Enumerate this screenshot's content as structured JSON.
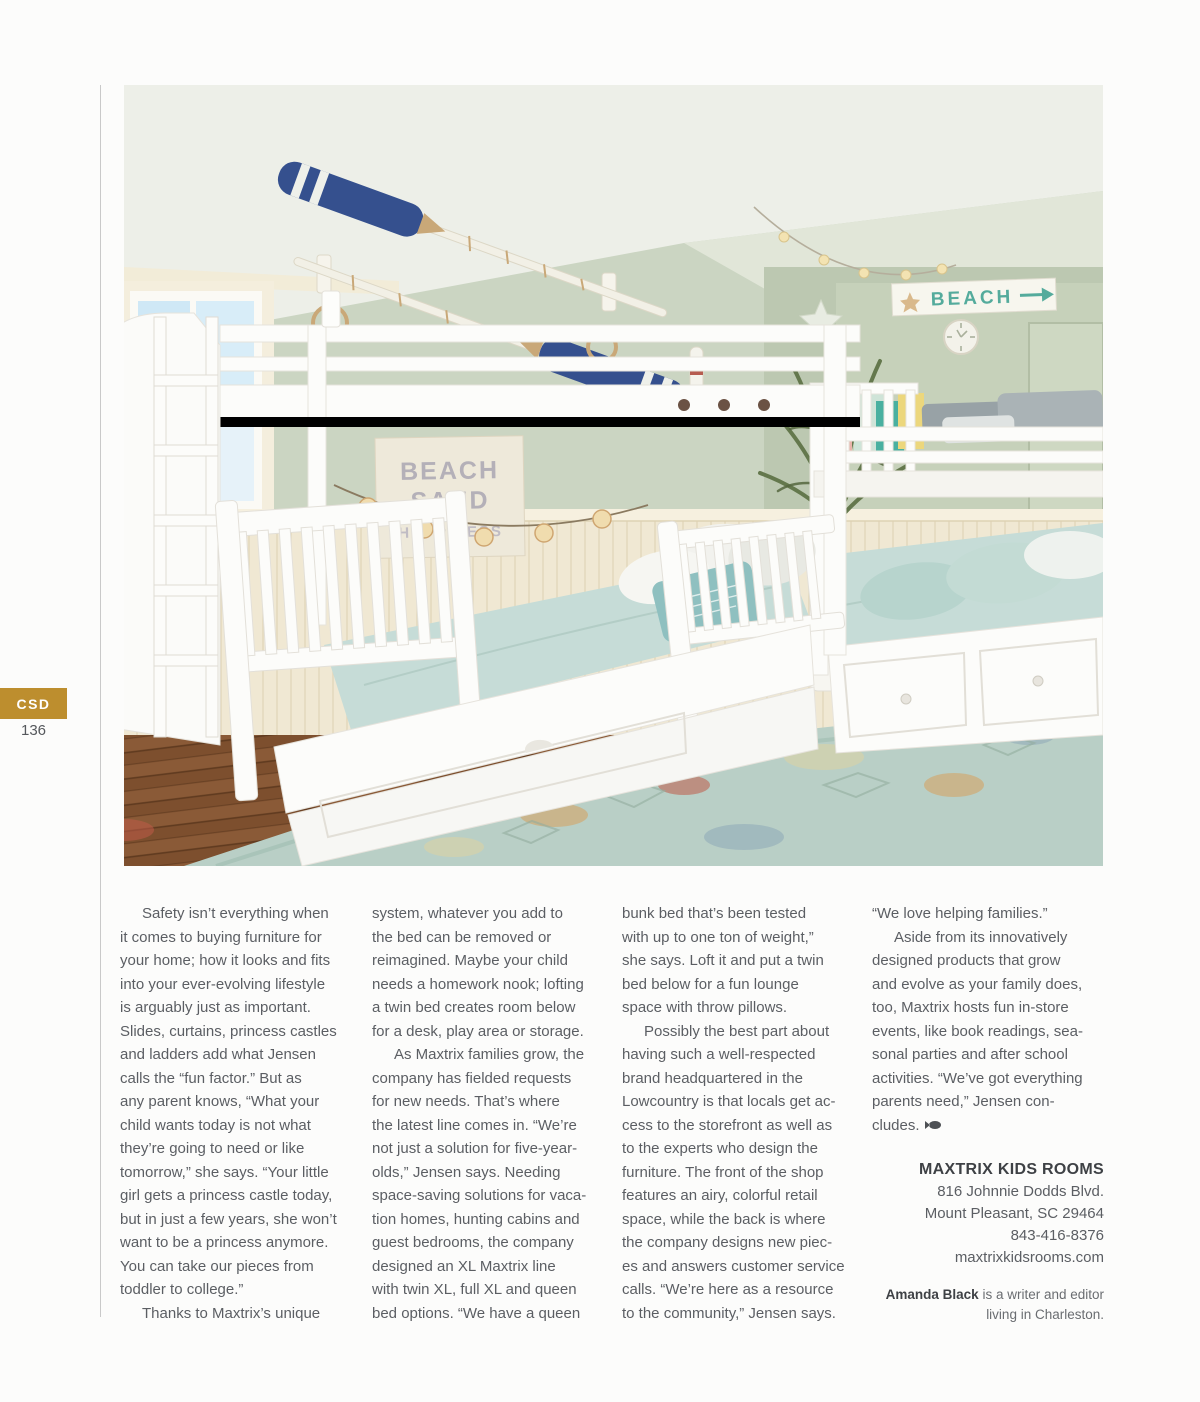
{
  "page": {
    "tab_label": "CSD",
    "page_number": "136",
    "accent_gold": "#bd8e2e"
  },
  "photo": {
    "description": "Coastal kids bedroom with two white bunk beds, seafoam bedding, decorative oars, beach signs, palm plant and distressed aqua rug",
    "beach_sign": "BEACH",
    "wall_art": {
      "line1": "BEACH",
      "line2": "SAND",
      "line3": "HAPPINESS"
    }
  },
  "article": {
    "columns": [
      {
        "paragraphs": [
          {
            "lines": [
              "Safety isn’t everything when",
              "it comes to buying furniture for",
              "your home; how it looks and fits",
              "into your ever-evolving lifestyle",
              "is arguably just as important.",
              "Slides, curtains, princess castles",
              "and ladders add what Jensen",
              "calls the “fun factor.” But as",
              "any parent knows, “What your",
              "child wants today is not what",
              "they’re going to need or like",
              "tomorrow,” she says. “Your little",
              "girl gets a princess castle today,",
              "but in just a few years, she won’t",
              "want to be a princess anymore.",
              "You can take our pieces from",
              "toddler to college.”"
            ]
          },
          {
            "lines": [
              "Thanks to Maxtrix’s unique"
            ]
          }
        ]
      },
      {
        "paragraphs": [
          {
            "lines": [
              "system, whatever you add to",
              "the bed can be removed or",
              "reimagined. Maybe your child",
              "needs a homework nook; lofting",
              "a twin bed creates room below",
              "for a desk, play area or storage."
            ]
          },
          {
            "lines": [
              "As Maxtrix families grow, the",
              "company has fielded requests",
              "for new needs. That’s where",
              "the latest line comes in. “We’re",
              "not just a solution for five-year-",
              "olds,” Jensen says. Needing",
              "space-saving solutions for vaca-",
              "tion homes, hunting cabins and",
              "guest bedrooms, the company",
              "designed an XL Maxtrix line",
              "with twin XL, full XL and queen",
              "bed options. “We have a queen"
            ]
          }
        ]
      },
      {
        "paragraphs": [
          {
            "lines": [
              "bunk bed that’s been tested",
              "with up to one ton of weight,”",
              "she says. Loft it and put a twin",
              "bed below for a fun lounge",
              "space with throw pillows."
            ]
          },
          {
            "lines": [
              "Possibly the best part about",
              "having such a well-respected",
              "brand headquartered in the",
              "Lowcountry is that locals get ac-",
              "cess to the storefront as well as",
              "to the experts who design the",
              "furniture. The front of the shop",
              "features an airy, colorful retail",
              "space, while the back is where",
              "the company designs new piec-",
              "es and answers customer service",
              "calls. “We’re here as a resource",
              "to the community,” Jensen says."
            ]
          }
        ]
      },
      {
        "paragraphs": [
          {
            "lines": [
              "“We love helping families.”"
            ]
          },
          {
            "lines": [
              "Aside from its innovatively",
              "designed products that grow",
              "and evolve as your family does,",
              "too, Maxtrix hosts fun in-store",
              "events, like book readings, sea-",
              "sonal parties and after school",
              "activities. “We’ve got everything",
              "parents need,” Jensen con-",
              "cludes."
            ]
          }
        ]
      }
    ]
  },
  "contact": {
    "name": "MAXTRIX KIDS ROOMS",
    "address_line1": "816 Johnnie Dodds Blvd.",
    "address_line2": "Mount Pleasant, SC 29464",
    "phone": "843-416-8376",
    "website": "maxtrixkidsrooms.com"
  },
  "byline": {
    "author": "Amanda Black",
    "text": " is a writer and editor living in Charleston."
  }
}
